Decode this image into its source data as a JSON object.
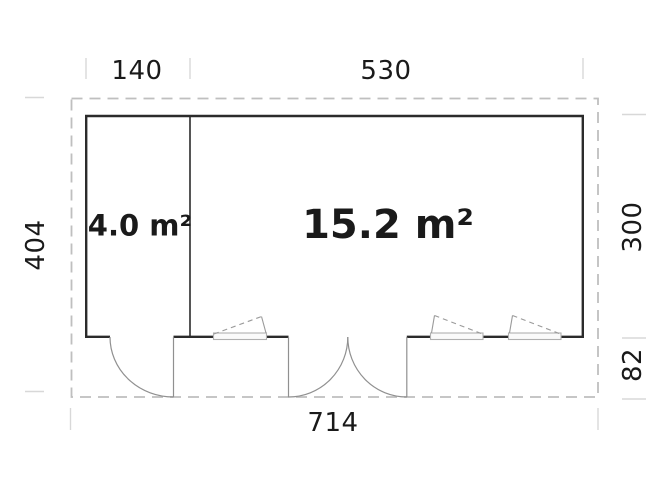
{
  "plan": {
    "title": "floor-plan",
    "dimensions": {
      "top_left": "140",
      "top_right": "530",
      "left": "404",
      "right_upper": "300",
      "right_lower": "82",
      "bottom": "714"
    },
    "rooms": {
      "small": {
        "area": "4.0 m²"
      },
      "large": {
        "area": "15.2 m²"
      }
    },
    "colors": {
      "wall": "#2b2b2b",
      "boundary_dash": "#bfbfbf",
      "dimension_tick": "#d8d8d8",
      "door_swing": "#909090",
      "window_frame": "#b0b0b0",
      "text": "#1a1a1a",
      "background": "#ffffff"
    }
  }
}
